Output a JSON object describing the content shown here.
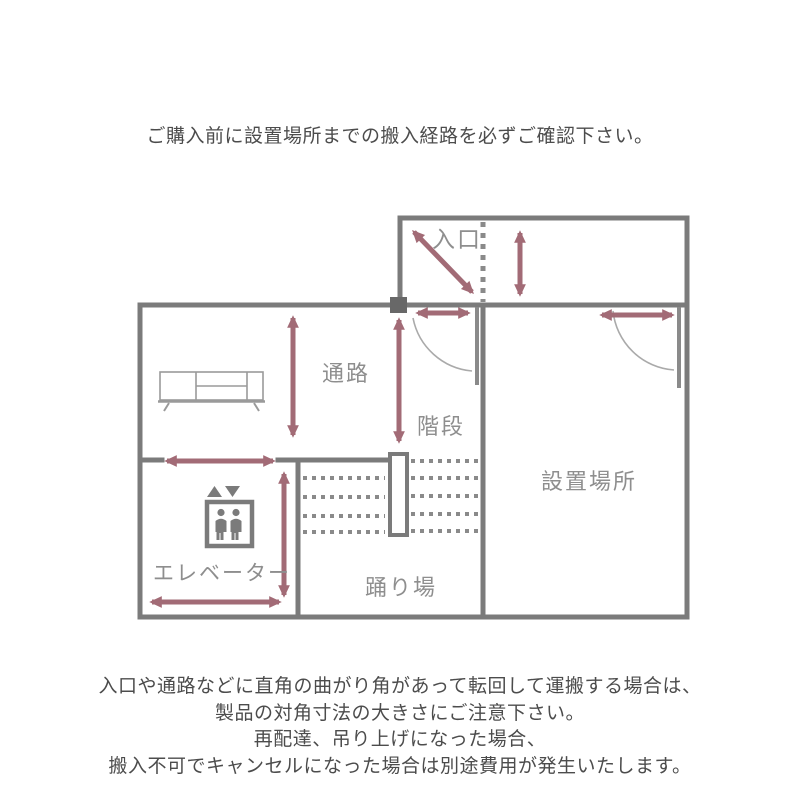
{
  "page": {
    "top_notice": "ご購入前に設置場所までの搬入経路を必ずご確認下さい。",
    "bottom_notice_lines": [
      "入口や通路などに直角の曲がり角があって転回して運搬する場合は、",
      "製品の対角寸法の大きさにご注意下さい。",
      "再配達、吊り上げになった場合、",
      "搬入不可でキャンセルになった場合は別途費用が発生いたします。"
    ]
  },
  "floorplan": {
    "labels": {
      "entrance": "入口",
      "passage": "通路",
      "stairs": "階段",
      "installation_site": "設置場所",
      "elevator": "エレベーター",
      "landing": "踊り場"
    },
    "icons": {
      "tv_board": "tv-board-icon",
      "elevator": "elevator-icon",
      "dimension_arrow": "double-headed-arrow"
    },
    "colors": {
      "wall": "#7b7b7b",
      "arrow": "#a26b76",
      "label": "#8e8e8e",
      "thin_line": "#9a9a9a",
      "hinge_post": "#686868",
      "notice_text": "#4c4c4c"
    }
  }
}
